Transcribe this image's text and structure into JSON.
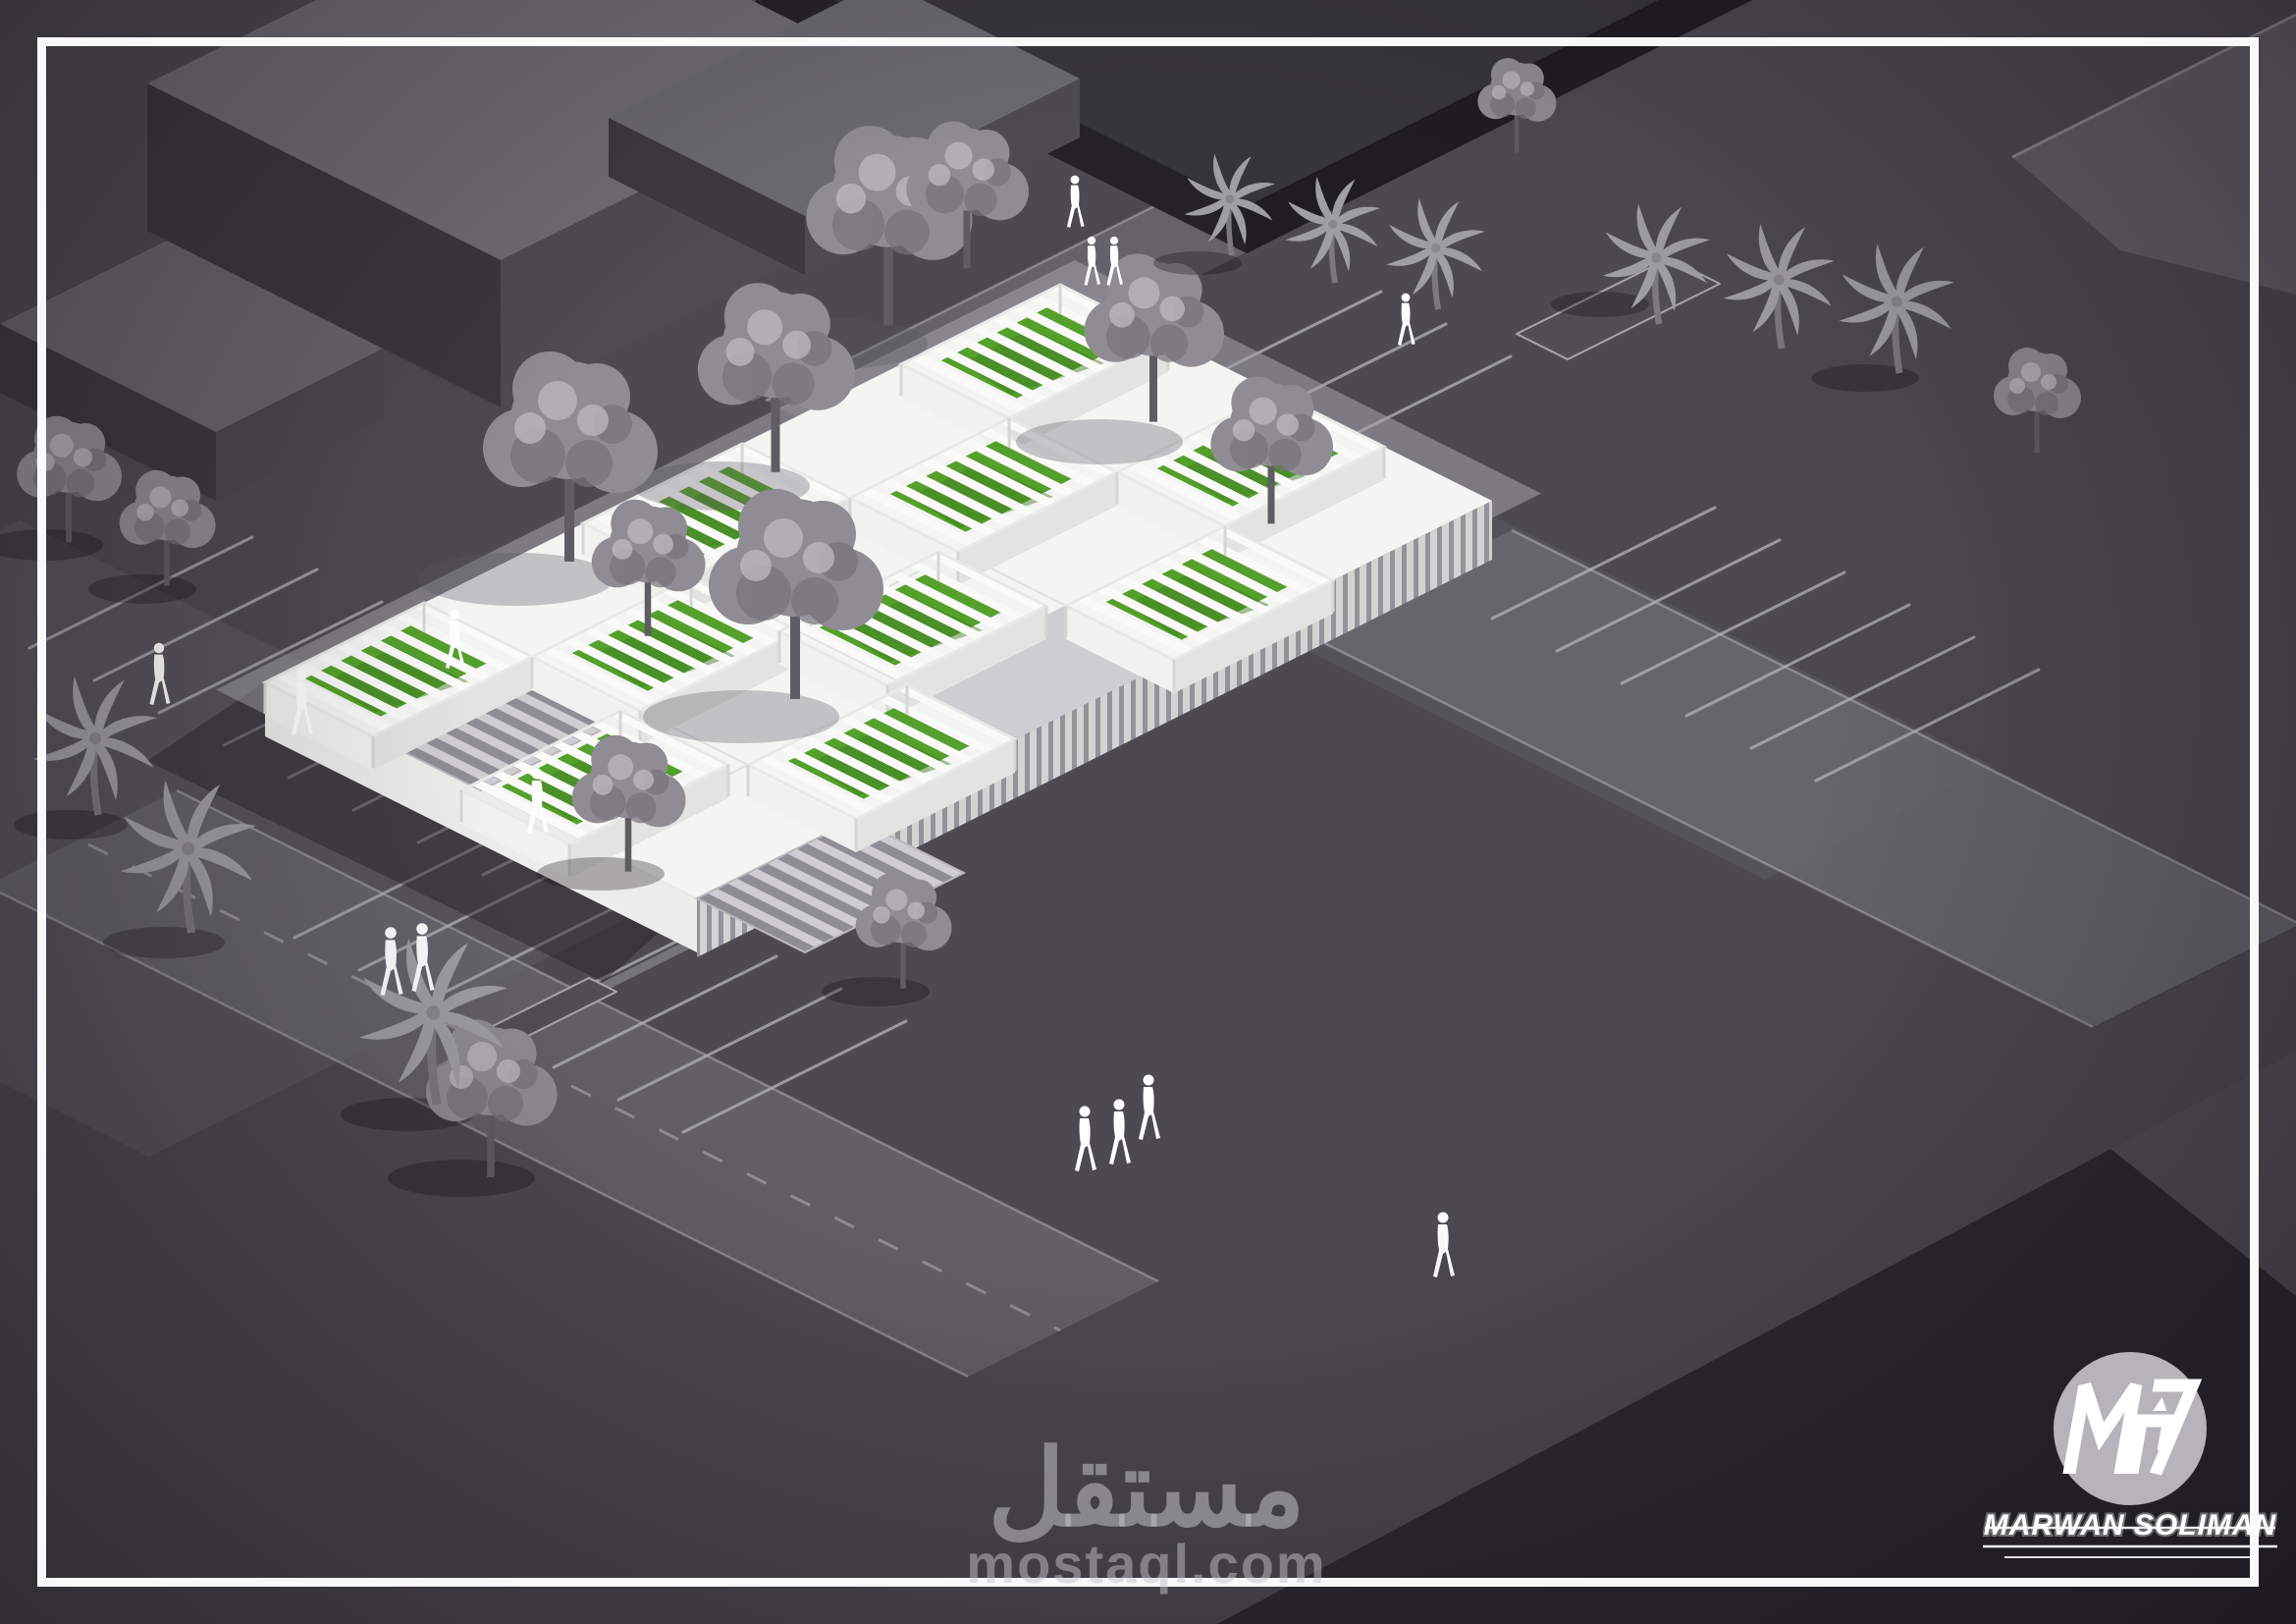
{
  "watermark": {
    "arabic_text": "مستقل",
    "latin_text": "mostaql.com"
  },
  "brand": {
    "name": "MARWAN SOLIMAN",
    "monogram_icon": "mas-monogram-icon"
  },
  "palette": {
    "ground": "#4c4a4f",
    "ground_light": "#57555b",
    "road": "#6c6a71",
    "block_top": "#6f6d73",
    "block_side_dark": "#3a383d",
    "dark_slab": "#37353c",
    "building_white": "#f4f4f2",
    "wall_shade": "#d8d8d6",
    "grass_green": "#55a02c",
    "grass_dark": "#3e7a21",
    "tree_gray": "#8f8d93",
    "palm_gray": "#a09ea5",
    "people_white": "#ffffff",
    "frame_white": "#ffffff",
    "watermark_gray": "#c3c1c9",
    "logo_circle": "#b6b4b8"
  }
}
